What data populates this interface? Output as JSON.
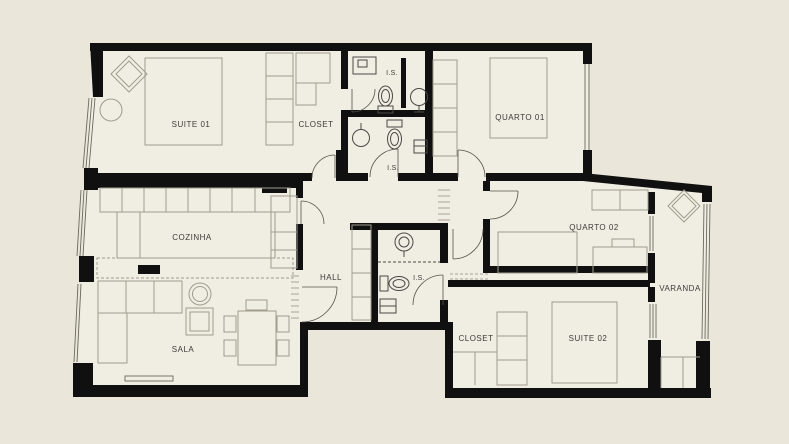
{
  "title": "apartment-floor-plan",
  "palette": {
    "background": "#eae7da",
    "floor": "#f0ede2",
    "wall": "#101010",
    "furniture_line": "#a09c8f",
    "fixture_line": "#4a4a45",
    "label_text": "#3c3c38"
  },
  "rooms": {
    "suite01": {
      "label": "SUITE 01"
    },
    "closet_top": {
      "label": "CLOSET"
    },
    "is_top": {
      "label": "I.S."
    },
    "is_mid": {
      "label": "I.S."
    },
    "quarto01": {
      "label": "QUARTO 01"
    },
    "cozinha": {
      "label": "COZINHA"
    },
    "hall": {
      "label": "HALL"
    },
    "is_hall": {
      "label": "I.S."
    },
    "quarto02": {
      "label": "QUARTO 02"
    },
    "varanda": {
      "label": "VARANDA"
    },
    "sala": {
      "label": "SALA"
    },
    "closet_bottom": {
      "label": "CLOSET"
    },
    "suite02": {
      "label": "SUITE 02"
    }
  },
  "fixtures": {
    "icons": [
      "toilet-icon",
      "pedestal-sink-icon",
      "washbasin-icon",
      "shelf-niche-icon",
      "bed-icon",
      "wardrobe-icon",
      "sofa-icon",
      "armchair-icon",
      "coffee-table-icon",
      "dining-table-icon",
      "kitchen-island-icon",
      "counter-icon",
      "bench-icon",
      "door-swing-icon",
      "window-icon"
    ]
  }
}
